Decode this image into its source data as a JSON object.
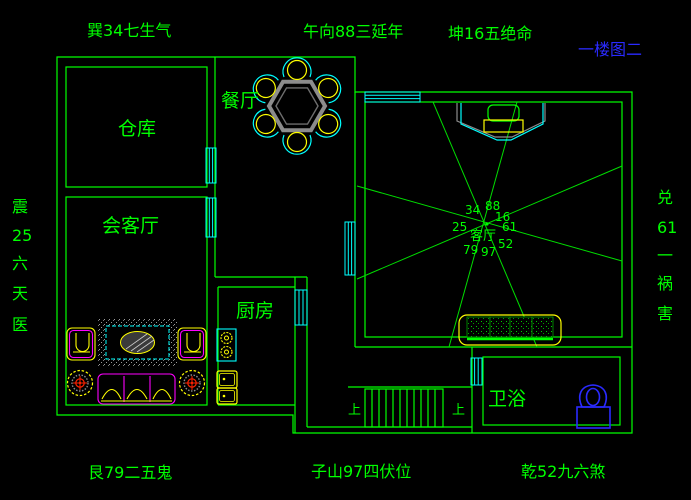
{
  "title": "一楼图二",
  "compass": {
    "top": [
      "巽34七生气",
      "午向88三延年",
      "坤16五绝命"
    ],
    "bottom": [
      "艮79二五鬼",
      "子山97四伏位",
      "乾52九六煞"
    ],
    "left": [
      "震",
      "25",
      "六",
      "天",
      "医"
    ],
    "right": [
      "兑",
      "61",
      "一",
      "祸",
      "害"
    ]
  },
  "rooms": {
    "cangku": "仓库",
    "huiketing": "会客厅",
    "canting": "餐厅",
    "chufang": "厨房",
    "keting": "客厅",
    "weiyu": "卫浴"
  },
  "center_numbers": {
    "nw": "34",
    "n": "88",
    "ne": "16",
    "w": "25",
    "e": "61",
    "sw": "79",
    "s": "97",
    "se": "52"
  },
  "stairs": {
    "up_left": "上",
    "up_right": "上"
  },
  "colors": {
    "background": "#000000",
    "wall_green": "#00ff00",
    "window_cyan": "#00ffff",
    "furniture_yellow": "#ffff00",
    "furniture_magenta": "#ff00ff",
    "table_gray": "#8c8c8c",
    "fixture_blue": "#2a2aff",
    "title_blue": "#2a2aff",
    "accent_red": "#ff2200"
  }
}
